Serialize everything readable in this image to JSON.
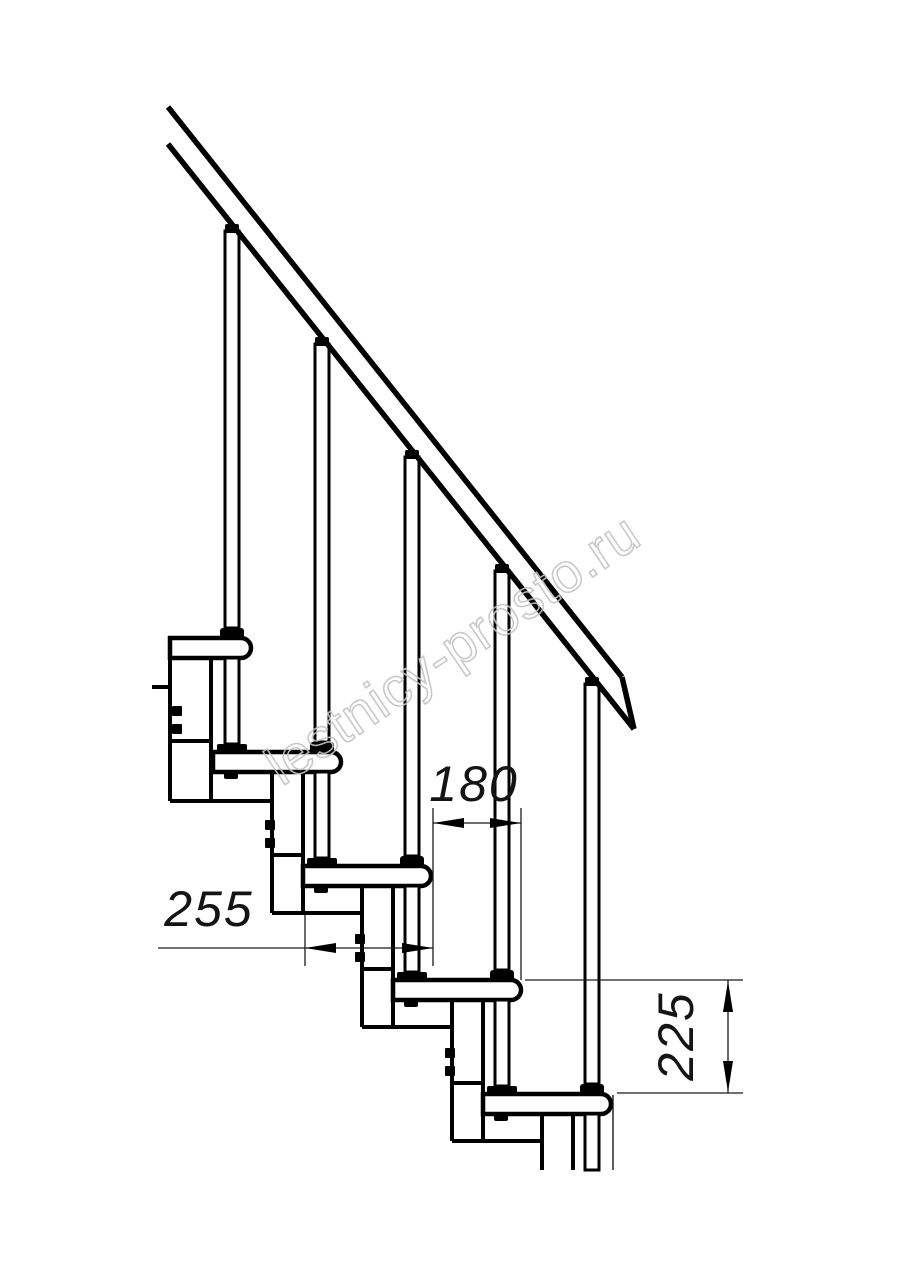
{
  "drawing": {
    "type": "technical-drawing",
    "subject": "modular staircase side elevation",
    "stroke_color": "#000000",
    "thin_line_color": "#1a1a1a",
    "background_color": "#ffffff"
  },
  "dimensions": {
    "d180": "180",
    "d255": "255",
    "d225": "225"
  },
  "watermark": {
    "text": "lestnicy-prosto.ru",
    "color": "#c4c4c4"
  }
}
